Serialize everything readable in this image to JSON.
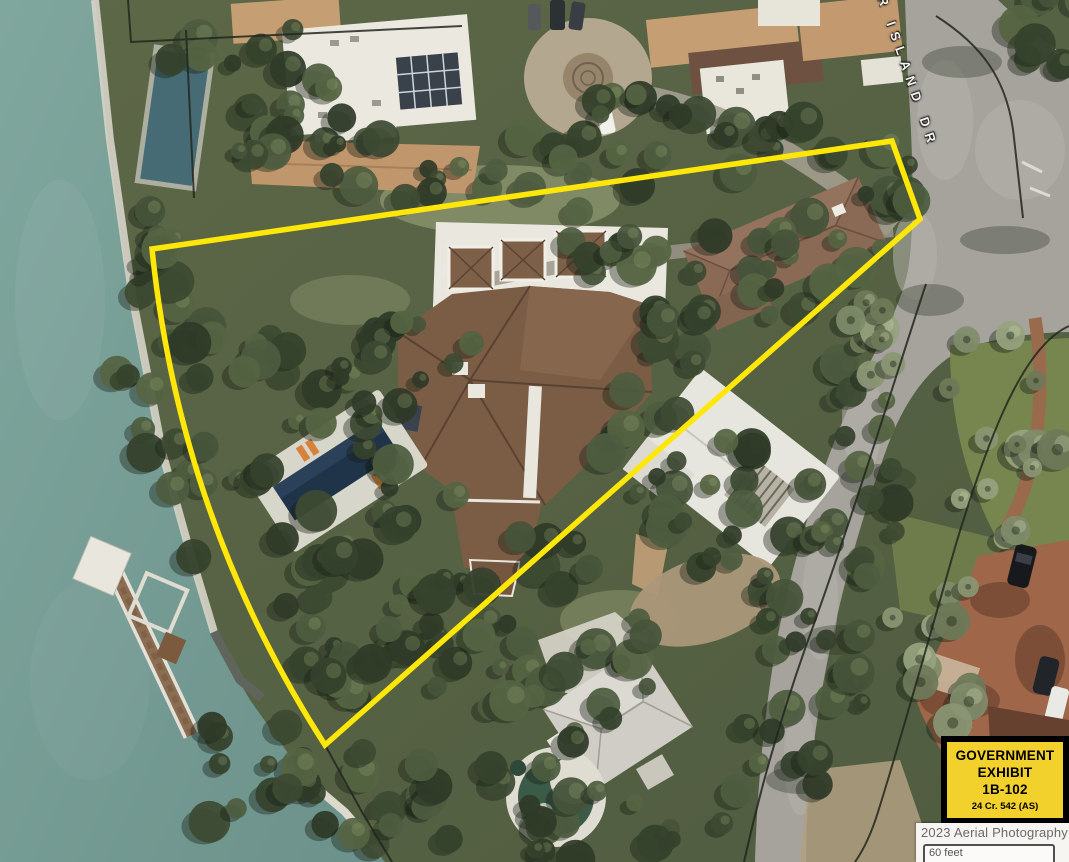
{
  "street": {
    "label": "R ISLAND DR"
  },
  "exhibit": {
    "line1": "GOVERNMENT",
    "line2": "EXHIBIT",
    "number": "1B-102",
    "case": "24 Cr. 542 (AS)",
    "bg_color": "#f2d12d",
    "border_color": "#000000"
  },
  "credit": {
    "text": "2023 Aerial Photography",
    "scale_text": "60 feet"
  },
  "overlay": {
    "boundary_color": "#ffe70a",
    "parcel_line_color": "#23271f"
  }
}
